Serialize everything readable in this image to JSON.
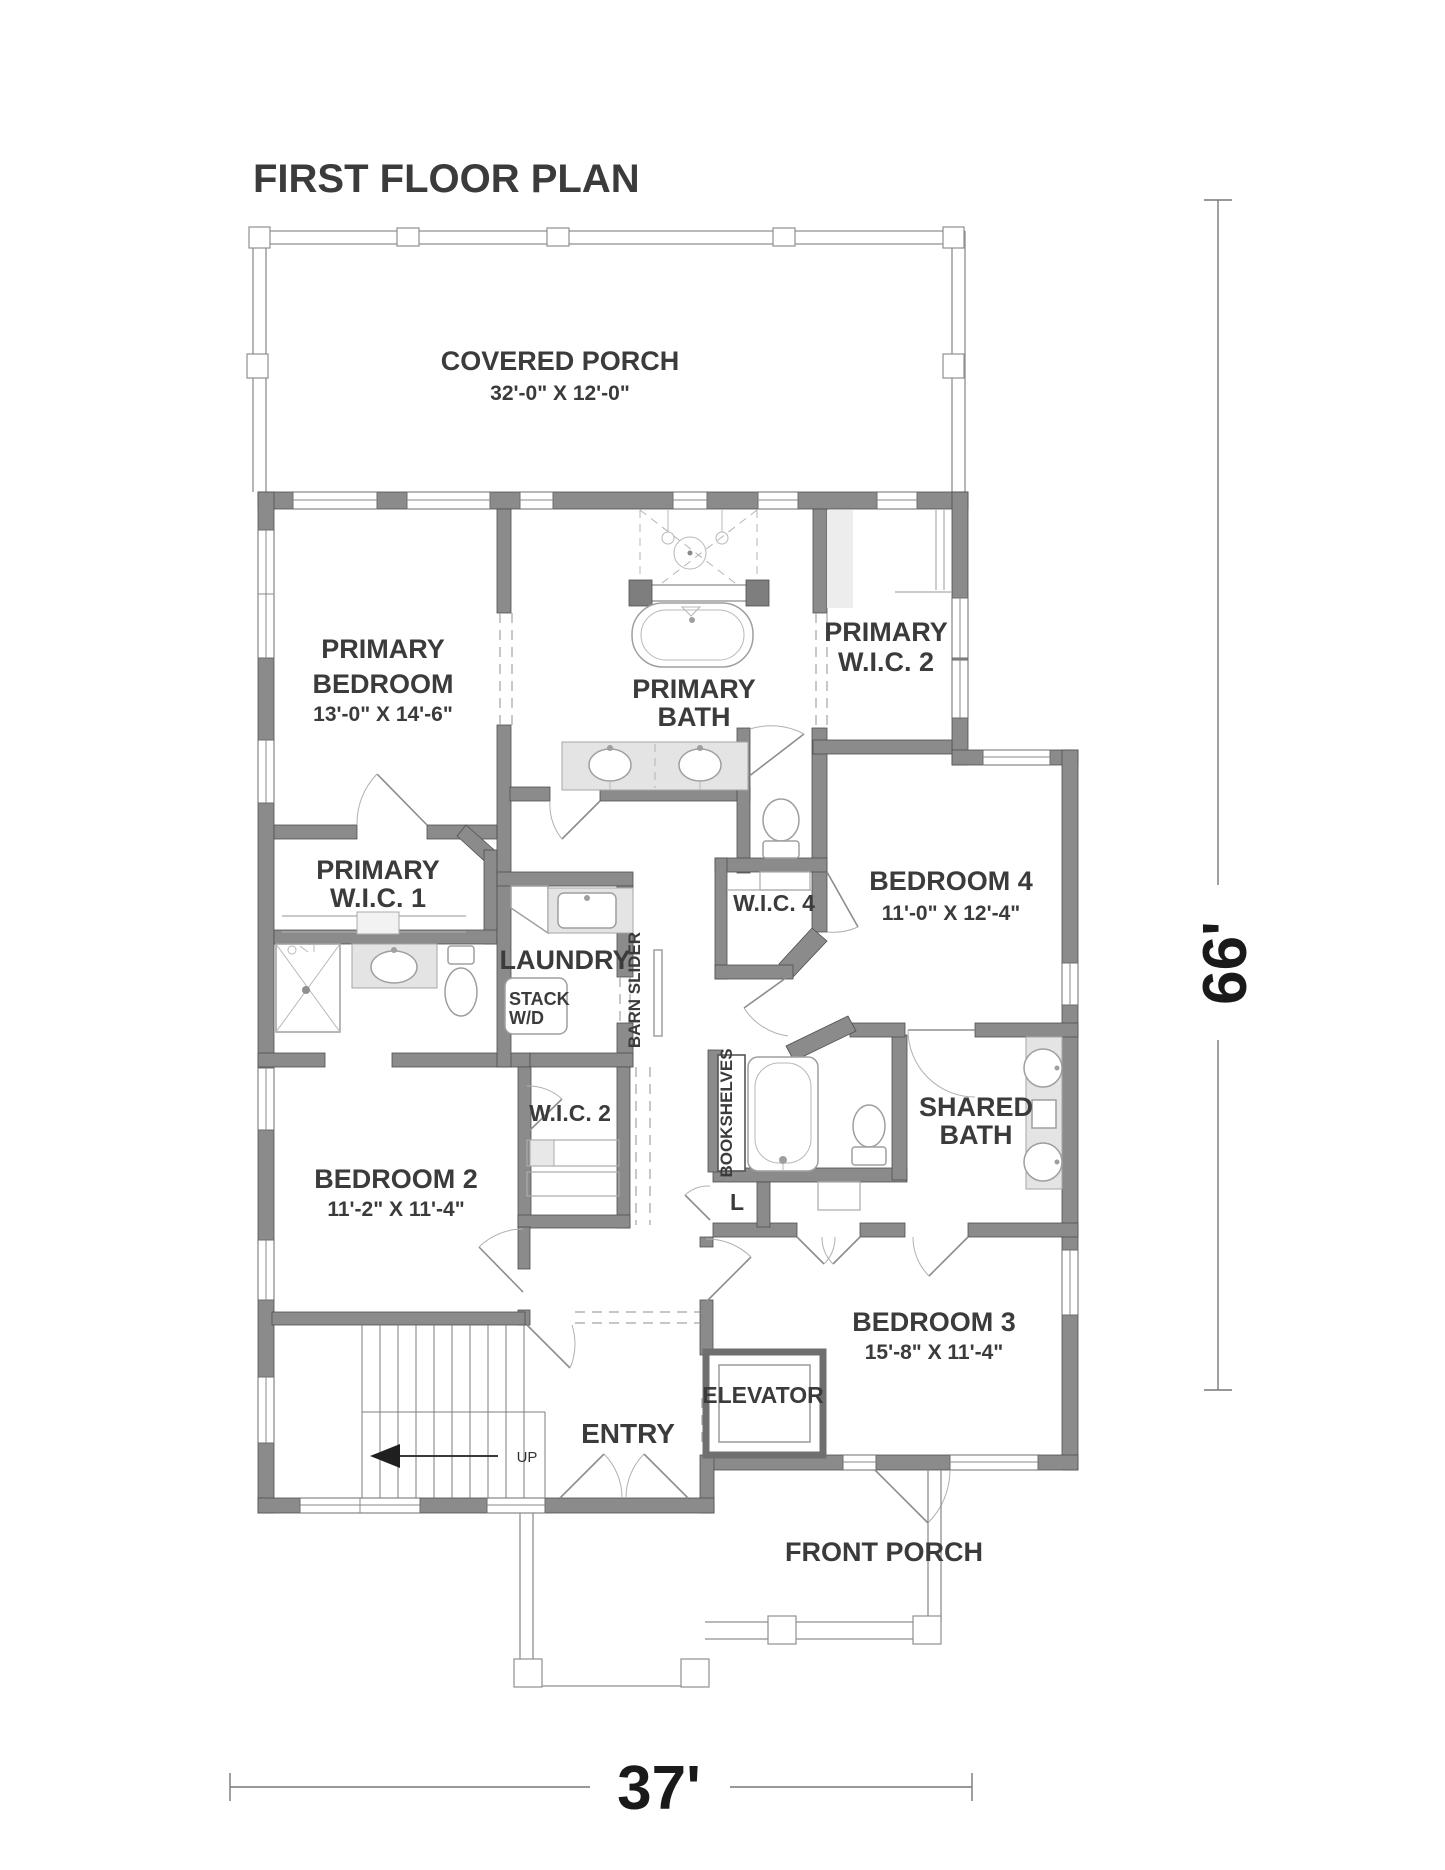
{
  "title": "FIRST FLOOR PLAN",
  "rooms": {
    "covered_porch": {
      "name": "COVERED PORCH",
      "dims": "32'-0\" X 12'-0\""
    },
    "primary_bedroom": {
      "line1": "PRIMARY",
      "line2": "BEDROOM",
      "dims": "13'-0\" X 14'-6\""
    },
    "primary_bath": {
      "line1": "PRIMARY",
      "line2": "BATH"
    },
    "primary_wic2": {
      "line1": "PRIMARY",
      "line2": "W.I.C. 2"
    },
    "primary_wic1": {
      "line1": "PRIMARY",
      "line2": "W.I.C. 1"
    },
    "laundry": {
      "name": "LAUNDRY"
    },
    "stack_wd": {
      "line1": "STACK",
      "line2": "W/D"
    },
    "barn_slider": {
      "name": "BARN SLIDER"
    },
    "wic4": {
      "name": "W.I.C. 4"
    },
    "bedroom4": {
      "name": "BEDROOM 4",
      "dims": "11'-0\" X 12'-4\""
    },
    "wic2": {
      "name": "W.I.C. 2"
    },
    "bookshelves": {
      "name": "BOOKSHELVES"
    },
    "shared_bath": {
      "line1": "SHARED",
      "line2": "BATH"
    },
    "bedroom2": {
      "name": "BEDROOM 2",
      "dims": "11'-2\" X 11'-4\""
    },
    "linen": {
      "name": "L"
    },
    "bedroom3": {
      "name": "BEDROOM 3",
      "dims": "15'-8\" X 11'-4\""
    },
    "elevator": {
      "name": "ELEVATOR"
    },
    "entry": {
      "name": "ENTRY"
    },
    "stairs": {
      "up_label": "UP"
    },
    "front_porch": {
      "name": "FRONT PORCH"
    }
  },
  "dimensions": {
    "height": "66'",
    "width": "37'"
  },
  "colors": {
    "wall": "#8b8b8b",
    "wall_edge": "#4f4f4f",
    "text": "#3b3b3b",
    "fixture_line": "#9f9f9f",
    "cabinet_fill": "#e4e4e4"
  }
}
